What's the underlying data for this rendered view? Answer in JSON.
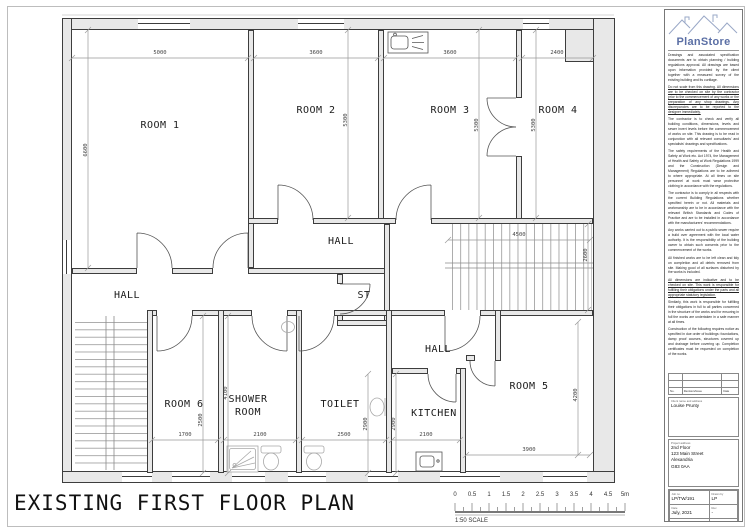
{
  "sheet": {
    "title": "EXISTING FIRST FLOOR PLAN"
  },
  "scale_bar": {
    "labels": [
      "0",
      "0.5",
      "1",
      "1.5",
      "2",
      "2.5",
      "3",
      "3.5",
      "4",
      "4.5",
      "5m"
    ],
    "caption": "1:50 SCALE"
  },
  "rooms": {
    "room1": {
      "label": "ROOM 1",
      "dim_top": "5000",
      "dim_side": "6600"
    },
    "room2": {
      "label": "ROOM 2",
      "dim_top": "3600",
      "dim_side": "5300"
    },
    "room3": {
      "label": "ROOM 3",
      "dim_top": "3600",
      "dim_side": "5300"
    },
    "room4": {
      "label": "ROOM 4",
      "dim_top": "2400",
      "dim_side": "5300"
    },
    "hall_center": {
      "label": "HALL"
    },
    "hall_left": {
      "label": "HALL"
    },
    "hall_lower": {
      "label": "HALL"
    },
    "st": {
      "label": "ST"
    },
    "stairs": {
      "dim_w": "4500",
      "dim_h": "2600"
    },
    "room6": {
      "label": "ROOM 6",
      "dim_bottom": "1700",
      "dim_side": "2500"
    },
    "shower": {
      "label_line1": "SHOWER",
      "label_line2": "ROOM",
      "dim_bottom": "2100",
      "dim_side": "4100"
    },
    "toilet": {
      "label": "TOILET",
      "dim_bottom": "2500",
      "dim_side": "2900"
    },
    "kitchen": {
      "label": "KITCHEN",
      "dim_bottom": "2100",
      "dim_side": "2900"
    },
    "room5": {
      "label": "ROOM 5",
      "dim_bottom": "3900",
      "dim_side": "4200"
    }
  },
  "titleblock": {
    "brand": "PlanStore",
    "notes": [
      "Drawings and associated specification documents are to obtain planning / building regulations approval. All drawings are based upon information provided by the client together with a measured survey of the existing building and its curtilage.",
      "Do not scale from this drawing. All dimensions are to be checked on site by the contractor prior to the commencement of any works or the preparation of any shop drawings. Any discrepancies are to be reported to the designer immediately.",
      "The contractor is to check and verify all building conditions, dimensions, levels and sewer invert levels before the commencement of works on site. This drawing is to be read in conjunction with all relevant consultants' and specialists' drawings and specifications.",
      "The safety requirements of the Health and Safety at Work etc. Act 1974, the Management of Health and Safety at Work Regulations 1999 and the Construction (Design and Management) Regulations are to be adhered to where appropriate. At all times on site personnel at work must wear protective clothing in accordance with the regulations.",
      "The contractor is to comply in all respects with the current Building Regulations whether specified herein or not. All materials and workmanship are to be in accordance with the relevant British Standards and Codes of Practice and are to be installed in accordance with the manufacturers' recommendations.",
      "Any works carried out to a public sewer require a build over agreement with the local water authority. It is the responsibility of the building owner to obtain such consents prior to the commencement of the works.",
      "All finished works are to be left clean and tidy on completion and all debris removed from site. Making good of all surfaces disturbed by the works is included.",
      "All dimensions are indicative and to be checked on site. This work is responsible for fulfilling their obligations under the parts and all appropriate statutory legislation.",
      "Similarly, this work is responsible for fulfilling their obligations in full to all parties concerned in the structure of the works and for ensuring in full the works are undertaken in a safe manner at all times.",
      "Construction of the following requires notice as specified in due order of buildings: foundations, damp proof courses, structures covered up and drainage before covering up. Completion certificates must be requested on completion of the works."
    ],
    "revision": {
      "no": "No.",
      "desc": "Revision/Issue",
      "date": "Date"
    },
    "client_label": "Client name and address",
    "client_name": "Louise Prunty",
    "site_label": "Project address",
    "site_lines": [
      "2nd Floor",
      "123 Main Street",
      "Alexandria",
      "G83 0AA"
    ],
    "fields": {
      "project_label": "Job no.",
      "project": "LP/TW/191",
      "date_label": "Date",
      "date": "July, 2021",
      "drawing_label": "Drawing no.",
      "drawing": "100",
      "drawn_label": "Drawn by",
      "drawn": "LP",
      "rev_label": "Rev",
      "rev": "-",
      "scale_label": "Scale",
      "scale": "1:50"
    }
  },
  "colors": {
    "wall_fill": "#e8e8e8",
    "wall_line": "#3d3d3d",
    "brand_blue": "#5b6fa5",
    "dim_text": "#444"
  }
}
